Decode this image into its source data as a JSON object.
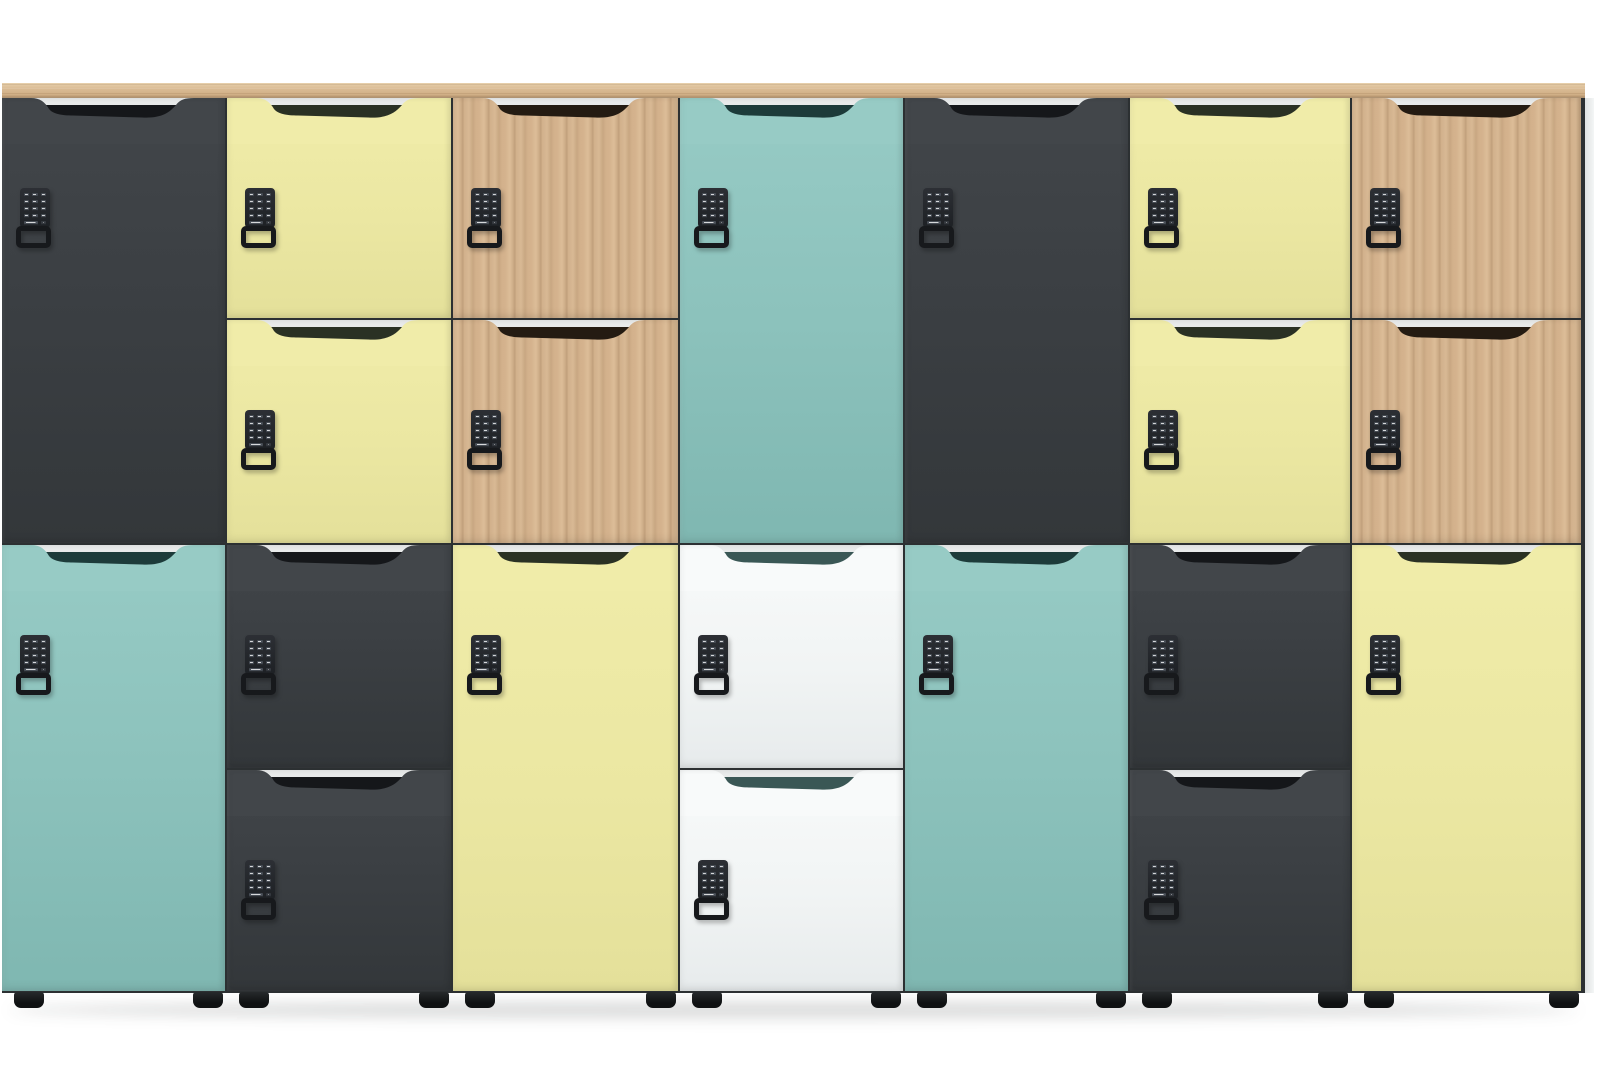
{
  "scene": {
    "description": "Product photo: bank of seven office smart-locker columns with coloured doors, wave grip cutouts, electronic keypad code locks with latch handles, oak worktop and black feet on a white floor",
    "background": "#ffffff"
  },
  "palette": {
    "seam": "#2c3032",
    "carcass_strip": "#e8eaea",
    "top_board_base": "#d8b992",
    "foot": "#17191a",
    "keypad_body": "#24272b",
    "keypad_key": "#474d55",
    "keypad_loop": "#17191c"
  },
  "door_colors": {
    "charcoal": {
      "face": "#42464a",
      "shadow": "#15171a"
    },
    "yellow": {
      "face": "#f0eca9",
      "shadow": "#2a3124"
    },
    "oak": {
      "face": "oak-grain",
      "shadow": "#241b12"
    },
    "teal": {
      "face": "#97cbc5",
      "shadow": "#1d3b3a"
    },
    "white": {
      "face": "#f8fafa",
      "shadow": "#3a5755"
    }
  },
  "cabinet": {
    "x": 2,
    "y": 83,
    "width": 1583,
    "doors_height": 895,
    "top_board_height": 15,
    "feet_height": 16
  },
  "grip": {
    "height": 46,
    "start_frac": 0.13,
    "end_frac": 0.86,
    "strip_height": 9
  },
  "keypad_layout": {
    "x_offset": 18,
    "y_offset": 90,
    "keys_rows": 4,
    "keys_cols": 3
  },
  "units": [
    {
      "id": "unit-1",
      "x": 0,
      "width": 225,
      "doors": [
        {
          "color": "charcoal",
          "y": 0,
          "height": 447
        },
        {
          "color": "teal",
          "y": 447,
          "height": 448
        }
      ]
    },
    {
      "id": "unit-2",
      "x": 225,
      "width": 226,
      "doors": [
        {
          "color": "yellow",
          "y": 0,
          "height": 222
        },
        {
          "color": "yellow",
          "y": 222,
          "height": 225
        },
        {
          "color": "charcoal",
          "y": 447,
          "height": 225
        },
        {
          "color": "charcoal",
          "y": 672,
          "height": 223
        }
      ]
    },
    {
      "id": "unit-3",
      "x": 451,
      "width": 227,
      "doors": [
        {
          "color": "oak",
          "y": 0,
          "height": 222
        },
        {
          "color": "oak",
          "y": 222,
          "height": 225
        },
        {
          "color": "yellow",
          "y": 447,
          "height": 448
        }
      ]
    },
    {
      "id": "unit-4",
      "x": 678,
      "width": 225,
      "doors": [
        {
          "color": "teal",
          "y": 0,
          "height": 447
        },
        {
          "color": "white",
          "y": 447,
          "height": 225
        },
        {
          "color": "white",
          "y": 672,
          "height": 223
        }
      ]
    },
    {
      "id": "unit-5",
      "x": 903,
      "width": 225,
      "doors": [
        {
          "color": "charcoal",
          "y": 0,
          "height": 447
        },
        {
          "color": "teal",
          "y": 447,
          "height": 448
        }
      ]
    },
    {
      "id": "unit-6",
      "x": 1128,
      "width": 222,
      "doors": [
        {
          "color": "yellow",
          "y": 0,
          "height": 222
        },
        {
          "color": "yellow",
          "y": 222,
          "height": 225
        },
        {
          "color": "charcoal",
          "y": 447,
          "height": 225
        },
        {
          "color": "charcoal",
          "y": 672,
          "height": 223
        }
      ]
    },
    {
      "id": "unit-7",
      "x": 1350,
      "width": 231,
      "doors": [
        {
          "color": "oak",
          "y": 0,
          "height": 222
        },
        {
          "color": "oak",
          "y": 222,
          "height": 225
        },
        {
          "color": "yellow",
          "y": 447,
          "height": 448
        }
      ]
    }
  ],
  "feet_per_unit": {
    "left_offset": 12,
    "right_offset": 34,
    "width": 30
  }
}
